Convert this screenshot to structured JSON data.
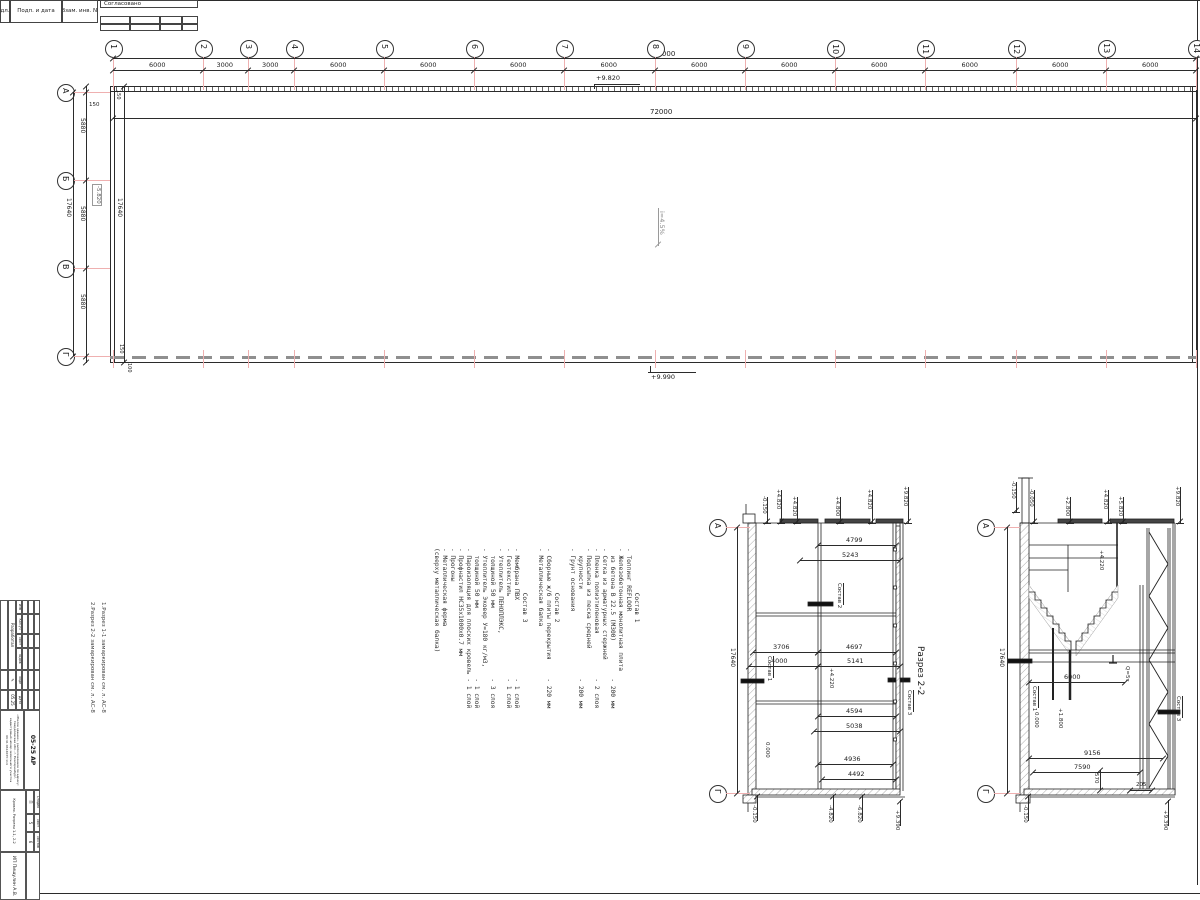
{
  "header_strip": {
    "cell_inv": "дл.",
    "cell_podp": "Подп. и дата",
    "cell_vzam": "Взам. инв. №",
    "approved": "Согласовано"
  },
  "plan": {
    "col_axes": [
      "1",
      "2",
      "3",
      "4",
      "5",
      "6",
      "7",
      "8",
      "9",
      "10",
      "11",
      "12",
      "13",
      "14"
    ],
    "col_spacings": [
      "6000",
      "3000",
      "3000",
      "6000",
      "6000",
      "6000",
      "6000",
      "6000",
      "6000",
      "6000",
      "6000",
      "6000",
      "6000"
    ],
    "total_top": "72000",
    "total_inner": "72000",
    "row_axes": [
      "А",
      "Б",
      "В",
      "Г"
    ],
    "row_spacings": [
      "5880",
      "5880",
      "5880"
    ],
    "row_total_outer": "17640",
    "row_total_inner": "17640",
    "offset_top": "150",
    "offset_corner": "150",
    "offset_bottom": "150",
    "offset_bottom2": "100",
    "elev_top": "+9.820",
    "elev_bottom": "+9.990",
    "slope": "i=4.5%",
    "level_box": "-5.820"
  },
  "notes": {
    "lines": [
      "            Состав 1",
      "- Топпинг REFLOOR",
      "- Железобетонная монолитная плита",
      "  из бетона В 22.5 (М300)          - 200 мм",
      "- Сетка из арматурных стержней",
      "- Пленка полиэтиленовая            - 2 слоя",
      "- Подсыпка из песка средней",
      "  крупности                        - 200 мм",
      "- Грунт основания",
      "",
      "            Состав 2",
      "- Сборные ж/б плиты перекрытия     - 220 мм",
      "- Металлическая балка",
      "",
      "            Состав 3",
      "- Мембрана ПВХ                     - 1 слой",
      "- Геотекстиль                      - 1 слой",
      "- Утеплитель ПЕНОПЛЭКС,",
      "  толщиной 50 мм                   - 3 слоя",
      "- Утеплитель Эковер У=180 кг/м3,",
      "  толщиной 50 мм                   - 1 слой",
      "- Пароизоляция для плоских кровель - 1 слой",
      "- Профнастил НС35х1000х0.7 мм",
      "- Прогоны",
      "- Металлическая ферма",
      "(сверху металлическая балка)"
    ]
  },
  "side_note": {
    "line1": "1.Разрез 1-1 замаркирован см. л. АС-8",
    "line2": "2.Разрез 2-2 замаркирован см. л. АС-8"
  },
  "section22": {
    "title": "Разрез 2-2",
    "axis_top": "А",
    "axis_bottom": "Г",
    "chain_total": "17640",
    "top_elevs": [
      "-0.150",
      "+4.820",
      "+4.820",
      "+4.800",
      "+4.820",
      "+9.820"
    ],
    "bottom_elevs": [
      "-0.150",
      "-4.820",
      "-6.820",
      "+9.390"
    ],
    "dims": [
      "4799",
      "5243",
      "3706",
      "4000",
      "4697",
      "5141",
      "4594",
      "5038",
      "4936",
      "4492"
    ],
    "labels": {
      "sostav1": "Состав 1",
      "sostav2": "Состав 2",
      "sostav3": "Состав 3",
      "zero": "0.000",
      "lvl": "+4.220"
    }
  },
  "section11": {
    "axis_top": "А",
    "axis_bottom": "Г",
    "chain_total": "17640",
    "top_elevs": [
      "-0.150",
      "-0.050",
      "+2.800",
      "+4.820",
      "+5.820",
      "+9.820"
    ],
    "bottom_elevs": [
      "-0.150",
      "+9.390"
    ],
    "dims": [
      "6000",
      "9156",
      "7590",
      "570",
      "205"
    ],
    "labels": {
      "sostav1": "Состав 1",
      "sostav3": "Состав 3",
      "zero": "0.000",
      "lvl1": "+1.800",
      "lvl2": "+4.220",
      "crane": "Q=5т"
    }
  },
  "stamp": {
    "header_cols": [
      "Изм",
      "Кол.уч",
      "Лист",
      "№док",
      "Подп",
      "Дата"
    ],
    "row_role": "Разработал",
    "row_date": "05.25",
    "doc_code": "05-25 АР",
    "project": "«Жилое здание», расположенное по адресу: Свердловская обл., г. Екатеринбург, кадастровый номер земельного участка 66:41:0614035:114",
    "stage_cols": [
      "Стадия",
      "Лист",
      "Листов"
    ],
    "stage_vals": [
      "П",
      "5",
      "6"
    ],
    "sheet_name": "Кровля. Разрезы 1-1, 2-2",
    "company": "ИП Пищулин А.В."
  }
}
